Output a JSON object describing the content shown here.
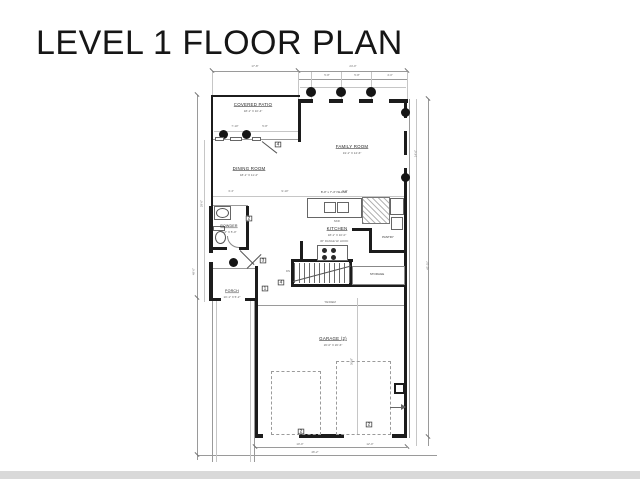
{
  "page": {
    "title": "LEVEL 1 FLOOR PLAN",
    "bg_color": "#ffffff",
    "wall_color": "#1c1c1c",
    "dim_line_color": "#9a9a9a",
    "footer_band_color": "#d9d9d9"
  },
  "plan": {
    "rooms": {
      "covered_patio": {
        "name": "COVERED PATIO",
        "dims": "18'-1\" X 10'-4\""
      },
      "family_room": {
        "name": "FAMILY ROOM",
        "dims": "19'-1\" X 14'-6\""
      },
      "dining_room": {
        "name": "DINING ROOM",
        "dims": "18'-1\" X 11'-2\""
      },
      "kitchen": {
        "name": "KITCHEN",
        "dims": "18'-1\" X 10'-0\""
      },
      "powder": {
        "name": "POWDER",
        "dims": "6'-2\" X 5'-0\""
      },
      "porch": {
        "name": "PORCH",
        "dims": "10'-1\" X 5'-2\""
      },
      "garage": {
        "name": "GARAGE (2)",
        "dims": "20'-0\" X 20'-6\""
      },
      "pantry": {
        "name": "PANTRY"
      },
      "storage": {
        "name": "STORAGE"
      }
    },
    "annotations": {
      "island": "8'-0\" x 7'-4\" ISLAND",
      "sink": "SINK",
      "range": "36\" RANGE W/ HOOD",
      "tandem": "TANDEM",
      "dn": "DN"
    },
    "keynotes": {
      "patio_door": "4",
      "powder_door": "2",
      "entry_door": "3",
      "porch_note": "1",
      "stair_note": "4",
      "garage_door_left": "2",
      "garage_door_right": "2"
    },
    "dimensions": {
      "top_left": "17'-8\"",
      "top_right": "24'-0\"",
      "col_a": "5'-8\"",
      "col_b": "5'-8\"",
      "col_c": "4'-0\"",
      "patio_a": "7'-10\"",
      "patio_b": "5'-8\"",
      "mid_a": "3'-4\"",
      "mid_b": "9'-10\"",
      "mid_c": "9'-8\"",
      "left_outer": "48'-0\"",
      "left_inner": "29'-0\"",
      "right_outer": "43'-10\"",
      "right_inner": "14'-6\"",
      "garage_depth": "30'-8\"",
      "bottom_a": "10'-0\"",
      "bottom_b": "12'-0\"",
      "bottom_total": "46'-2\""
    }
  }
}
